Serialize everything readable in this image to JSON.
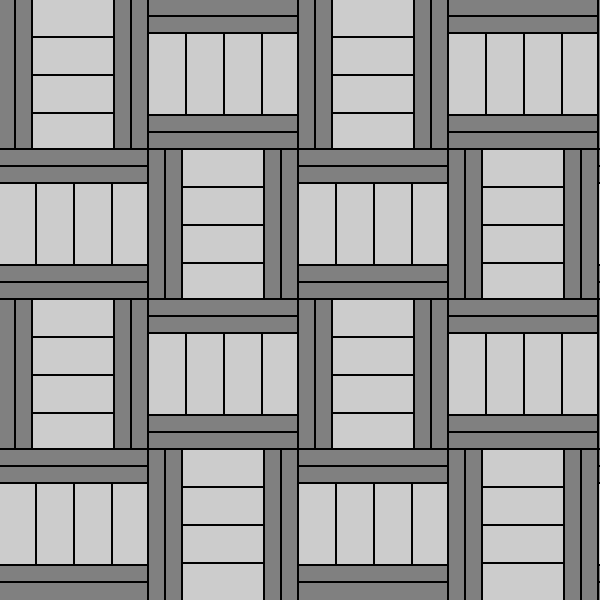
{
  "pattern": {
    "name": "basketweave-parquet-pattern",
    "description": "4x4 checkerboard basket-weave of framed square tiles; V tiles have two vertical gray rails on each side of a light column split into 4 horizontal strips; H tiles have two horizontal gray rails above and below 4 light vertical strips; all separated by thin black lines",
    "colors": {
      "line": "#000000",
      "rail": "#808080",
      "panel": "#cccccc"
    },
    "geometry": {
      "tile_size": 150,
      "offset_x": -3,
      "offset_y": -2,
      "line_width": 2,
      "rail_width": 15,
      "rail_offsets": [
        2,
        19,
        118,
        135
      ],
      "rail_length": 148,
      "panel_offset": 36,
      "panel_width": 80,
      "strip_offsets": [
        2,
        40,
        78,
        116
      ],
      "strip_sizes": [
        36,
        36,
        36,
        34
      ],
      "last_row_extension": 2
    },
    "orientations": [
      [
        "V",
        "H",
        "V",
        "H",
        "V"
      ],
      [
        "H",
        "V",
        "H",
        "V",
        "H"
      ],
      [
        "V",
        "H",
        "V",
        "H",
        "V"
      ],
      [
        "H",
        "V",
        "H",
        "V",
        "H"
      ]
    ]
  }
}
